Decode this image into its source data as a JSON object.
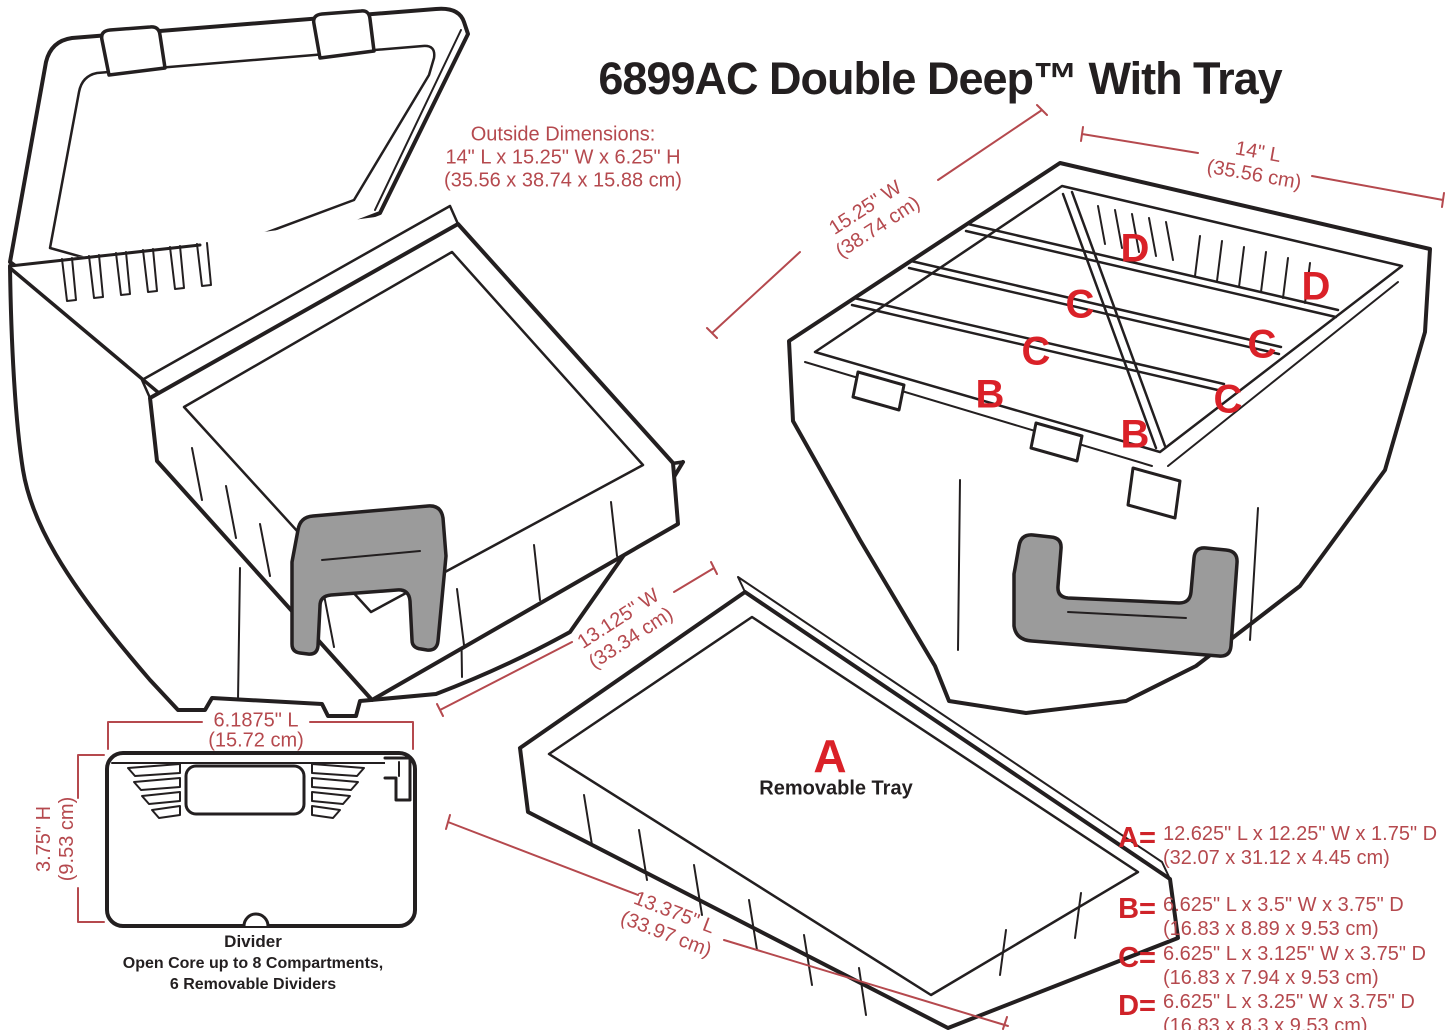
{
  "title": "6899AC Double Deep™ With Tray",
  "colors": {
    "line_black": "#231f20",
    "red_letter": "#da2128",
    "red_dimension": "#b5494e",
    "handle_gray": "#9b9b9b"
  },
  "outside_dimensions": {
    "heading": "Outside Dimensions:",
    "inches": "14\" L x 15.25\" W x 6.25\" H",
    "cm": "(35.56 x 38.74 x 15.88 cm)"
  },
  "divider_box": {
    "width": {
      "inches": "15.25\" W",
      "cm": "(38.74 cm)"
    },
    "length": {
      "inches": "14\" L",
      "cm": "(35.56 cm)"
    },
    "letters": [
      "D",
      "C",
      "C",
      "B",
      "B",
      "C",
      "C",
      "D"
    ]
  },
  "tray": {
    "letter": "A",
    "caption": "Removable Tray",
    "width": {
      "inches": "13.125\" W",
      "cm": "(33.34 cm)"
    },
    "length": {
      "inches": "13.375\" L",
      "cm": "(33.97 cm)"
    }
  },
  "divider": {
    "caption": "Divider",
    "note_line1": "Open Core up to 8 Compartments,",
    "note_line2": "6 Removable Dividers",
    "length": {
      "inches": "6.1875\" L",
      "cm": "(15.72 cm)"
    },
    "height": {
      "inches": "3.75\" H",
      "cm": "(9.53 cm)"
    }
  },
  "legend": [
    {
      "key": "A=",
      "inches": "12.625\" L x 12.25\" W x 1.75\" D",
      "cm": "(32.07 x 31.12 x 4.45 cm)"
    },
    {
      "key": "B=",
      "inches": "6.625\" L x 3.5\" W x 3.75\" D",
      "cm": "(16.83 x 8.89 x 9.53 cm)"
    },
    {
      "key": "C=",
      "inches": "6.625\" L x 3.125\" W x 3.75\" D",
      "cm": "(16.83 x 7.94 x 9.53 cm)"
    },
    {
      "key": "D=",
      "inches": "6.625\" L x 3.25\" W x 3.75\" D",
      "cm": "(16.83 x 8.3 x 9.53 cm)"
    }
  ]
}
